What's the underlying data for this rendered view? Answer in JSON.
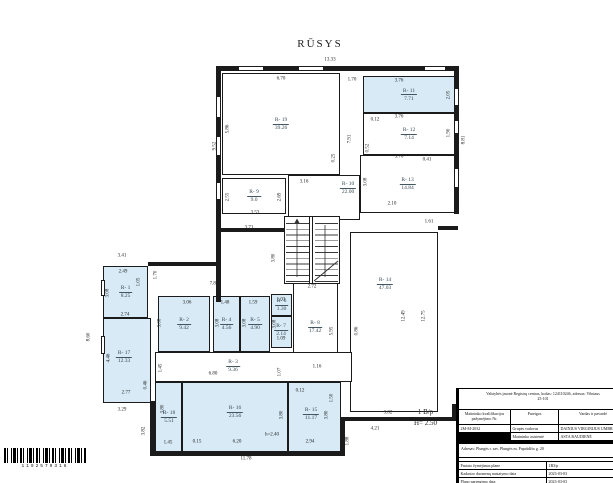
{
  "title": "RŪSYS",
  "building_label": {
    "line1": "1 B/p",
    "line2": "H= 2.50"
  },
  "barcode": {
    "digits": "1192579316"
  },
  "colors": {
    "room_fill": "#d7eaf6",
    "wall": "#1b1b1b"
  },
  "plan": {
    "rooms": [
      {
        "id": "R- 19",
        "area": "39.26",
        "x": 222,
        "y": 73,
        "w": 118,
        "h": 102,
        "f": 0
      },
      {
        "id": "R- 9",
        "area": "9.0",
        "x": 222,
        "y": 178,
        "w": 64,
        "h": 36,
        "f": 0
      },
      {
        "id": "R- 10",
        "area": "22.00",
        "x": 288,
        "y": 175,
        "w": 72,
        "h": 45,
        "f": 0,
        "lx": 348,
        "ly": 188
      },
      {
        "id": "R- 11",
        "area": "7.71",
        "x": 363,
        "y": 76,
        "w": 92,
        "h": 37,
        "f": 1
      },
      {
        "id": "R- 12",
        "area": "7.14",
        "x": 363,
        "y": 113,
        "w": 92,
        "h": 42,
        "f": 0
      },
      {
        "id": "R- 13",
        "area": "14.84",
        "x": 360,
        "y": 155,
        "w": 95,
        "h": 58,
        "f": 0
      },
      {
        "id": "R- 14",
        "area": "47.03",
        "x": 350,
        "y": 232,
        "w": 88,
        "h": 180,
        "f": 0,
        "lx": 385,
        "ly": 284
      },
      {
        "id": "R- 1",
        "area": "8.25",
        "x": 103,
        "y": 266,
        "w": 45,
        "h": 52,
        "f": 1
      },
      {
        "id": "R- 17",
        "area": "12.33",
        "x": 103,
        "y": 318,
        "w": 48,
        "h": 85,
        "f": 1,
        "lx": 124,
        "ly": 357
      },
      {
        "id": "R- 2",
        "area": "9.42",
        "x": 158,
        "y": 296,
        "w": 52,
        "h": 56,
        "f": 1
      },
      {
        "id": "R- 4",
        "area": "4.56",
        "x": 213,
        "y": 296,
        "w": 27,
        "h": 56,
        "f": 1
      },
      {
        "id": "R- 5",
        "area": "4.90",
        "x": 240,
        "y": 296,
        "w": 30,
        "h": 56,
        "f": 1
      },
      {
        "id": "R- 6",
        "area": "1.30",
        "x": 271,
        "y": 294,
        "w": 21,
        "h": 22,
        "f": 1
      },
      {
        "id": "R- 7",
        "area": "2.14",
        "x": 271,
        "y": 316,
        "w": 21,
        "h": 32,
        "f": 1,
        "lx": 281,
        "ly": 330
      },
      {
        "id": "R- 8",
        "area": "17.42",
        "x": 293,
        "y": 283,
        "w": 45,
        "h": 95,
        "f": 0,
        "lx": 315,
        "ly": 327
      },
      {
        "id": "R- 3",
        "area": "9.36",
        "x": 155,
        "y": 352,
        "w": 197,
        "h": 30,
        "f": 0,
        "lx": 233,
        "ly": 366
      },
      {
        "id": "R- 18",
        "area": "5.51",
        "x": 155,
        "y": 382,
        "w": 27,
        "h": 71,
        "f": 1,
        "lx": 169,
        "ly": 417
      },
      {
        "id": "R- 16",
        "area": "23.56",
        "x": 182,
        "y": 382,
        "w": 106,
        "h": 71,
        "f": 1,
        "lx": 235,
        "ly": 412
      },
      {
        "id": "R- 15",
        "area": "11.17",
        "x": 288,
        "y": 382,
        "w": 53,
        "h": 71,
        "f": 1,
        "lx": 311,
        "ly": 414
      }
    ],
    "dimensions": [
      {
        "t": "13.33",
        "x": 330,
        "y": 60
      },
      {
        "t": "6.70",
        "x": 281,
        "y": 79
      },
      {
        "t": "1.70",
        "x": 352,
        "y": 80
      },
      {
        "t": "3.76",
        "x": 399,
        "y": 81
      },
      {
        "t": "2.05",
        "x": 449,
        "y": 95,
        "r": 1
      },
      {
        "t": "3.76",
        "x": 399,
        "y": 117
      },
      {
        "t": "0.12",
        "x": 375,
        "y": 120
      },
      {
        "t": "1.90",
        "x": 449,
        "y": 133,
        "r": 1
      },
      {
        "t": "8.81",
        "x": 464,
        "y": 140,
        "r": 1
      },
      {
        "t": "3.76",
        "x": 399,
        "y": 157
      },
      {
        "t": "0.41",
        "x": 427,
        "y": 160
      },
      {
        "t": "0.52",
        "x": 368,
        "y": 148,
        "r": 1
      },
      {
        "t": "7.91",
        "x": 350,
        "y": 139,
        "r": 1
      },
      {
        "t": "3.08",
        "x": 366,
        "y": 182,
        "r": 1
      },
      {
        "t": "2.10",
        "x": 392,
        "y": 204
      },
      {
        "t": "1.61",
        "x": 429,
        "y": 222
      },
      {
        "t": "9.52",
        "x": 215,
        "y": 146,
        "r": 1
      },
      {
        "t": "5.86",
        "x": 228,
        "y": 129,
        "r": 1
      },
      {
        "t": "0.25",
        "x": 334,
        "y": 158,
        "r": 1
      },
      {
        "t": "3.16",
        "x": 304,
        "y": 182
      },
      {
        "t": "2.55",
        "x": 228,
        "y": 197,
        "r": 1
      },
      {
        "t": "2.69",
        "x": 280,
        "y": 197,
        "r": 1
      },
      {
        "t": "3.53",
        "x": 255,
        "y": 213
      },
      {
        "t": "3.71",
        "x": 249,
        "y": 228
      },
      {
        "t": "3.80",
        "x": 274,
        "y": 258,
        "r": 1
      },
      {
        "t": "2.72",
        "x": 312,
        "y": 287
      },
      {
        "t": "7.86",
        "x": 214,
        "y": 284
      },
      {
        "t": "3.41",
        "x": 122,
        "y": 256
      },
      {
        "t": "2.49",
        "x": 123,
        "y": 272
      },
      {
        "t": "1.70",
        "x": 156,
        "y": 275,
        "r": 1
      },
      {
        "t": "1.05",
        "x": 139,
        "y": 282,
        "r": 1
      },
      {
        "t": "3.08",
        "x": 108,
        "y": 293,
        "r": 1
      },
      {
        "t": "2.74",
        "x": 125,
        "y": 315
      },
      {
        "t": "8.60",
        "x": 89,
        "y": 337,
        "r": 1
      },
      {
        "t": "4.46",
        "x": 109,
        "y": 358,
        "r": 1
      },
      {
        "t": "0.46",
        "x": 146,
        "y": 385,
        "r": 1
      },
      {
        "t": "2.77",
        "x": 126,
        "y": 393
      },
      {
        "t": "3.29",
        "x": 122,
        "y": 410
      },
      {
        "t": "3.82",
        "x": 144,
        "y": 431,
        "r": 1
      },
      {
        "t": "1.45",
        "x": 161,
        "y": 368,
        "r": 1
      },
      {
        "t": "3.06",
        "x": 187,
        "y": 303
      },
      {
        "t": "3.08",
        "x": 160,
        "y": 323,
        "r": 1
      },
      {
        "t": "1.48",
        "x": 225,
        "y": 303
      },
      {
        "t": "3.08",
        "x": 218,
        "y": 323,
        "r": 1
      },
      {
        "t": "1.59",
        "x": 253,
        "y": 303
      },
      {
        "t": "3.08",
        "x": 245,
        "y": 323,
        "r": 1
      },
      {
        "t": "1.03",
        "x": 281,
        "y": 300
      },
      {
        "t": "3.08",
        "x": 275,
        "y": 324,
        "r": 1
      },
      {
        "t": "1.09",
        "x": 281,
        "y": 339
      },
      {
        "t": "5.95",
        "x": 332,
        "y": 331,
        "r": 1
      },
      {
        "t": "0.86",
        "x": 357,
        "y": 331,
        "r": 1
      },
      {
        "t": "12.49",
        "x": 404,
        "y": 316,
        "r": 1
      },
      {
        "t": "12.75",
        "x": 424,
        "y": 316,
        "r": 1
      },
      {
        "t": "6.80",
        "x": 213,
        "y": 374
      },
      {
        "t": "1.16",
        "x": 317,
        "y": 367
      },
      {
        "t": "1.07",
        "x": 280,
        "y": 372,
        "r": 1
      },
      {
        "t": "3.80",
        "x": 163,
        "y": 409,
        "r": 1
      },
      {
        "t": "1.45",
        "x": 168,
        "y": 443
      },
      {
        "t": "0.15",
        "x": 197,
        "y": 442
      },
      {
        "t": "6.20",
        "x": 237,
        "y": 442
      },
      {
        "t": "3.80",
        "x": 282,
        "y": 415,
        "r": 1
      },
      {
        "t": "h=2.40",
        "x": 272,
        "y": 435
      },
      {
        "t": "0.12",
        "x": 300,
        "y": 391
      },
      {
        "t": "1.50",
        "x": 332,
        "y": 398,
        "r": 1
      },
      {
        "t": "3.80",
        "x": 327,
        "y": 415,
        "r": 1
      },
      {
        "t": "2.94",
        "x": 310,
        "y": 442
      },
      {
        "t": "11.78",
        "x": 246,
        "y": 459
      },
      {
        "t": "1.88",
        "x": 348,
        "y": 441,
        "r": 1
      },
      {
        "t": "3.82",
        "x": 388,
        "y": 413
      },
      {
        "t": "4.21",
        "x": 375,
        "y": 429
      }
    ]
  },
  "titleblock": {
    "org_line1": "Valstybės įmonė Registrų centras, kodas: 124110246, adresas: Vilniaus",
    "org_line2": "25-101",
    "col_headers": [
      "Matininko kvalifikacijos pažymėjimo Nr.",
      "Pareigos",
      "Vardas ir pavardė"
    ],
    "rows": [
      {
        "nr": "2M-M-2032",
        "pareigos": "Grupės vadovas",
        "vardas": "DAINIUS VIRGINIJUS UMBR"
      },
      {
        "nr": "",
        "pareigos": "Matininko asistentė",
        "vardas": "ASTA RAUDIENĖ"
      }
    ],
    "address": "Adresas: Plungės r. sav. Plungės m. Paprūdžio g. 20",
    "info_rows": [
      {
        "label": "Pastato žymėjimas plane",
        "value": "1B3/p"
      },
      {
        "label": "Kadastro duomenų nustatymo data",
        "value": "2023-03-03"
      },
      {
        "label": "Plano parengimo data",
        "value": "2023-03-03"
      },
      {
        "label": "Mastelis",
        "value": "1:100"
      }
    ]
  }
}
